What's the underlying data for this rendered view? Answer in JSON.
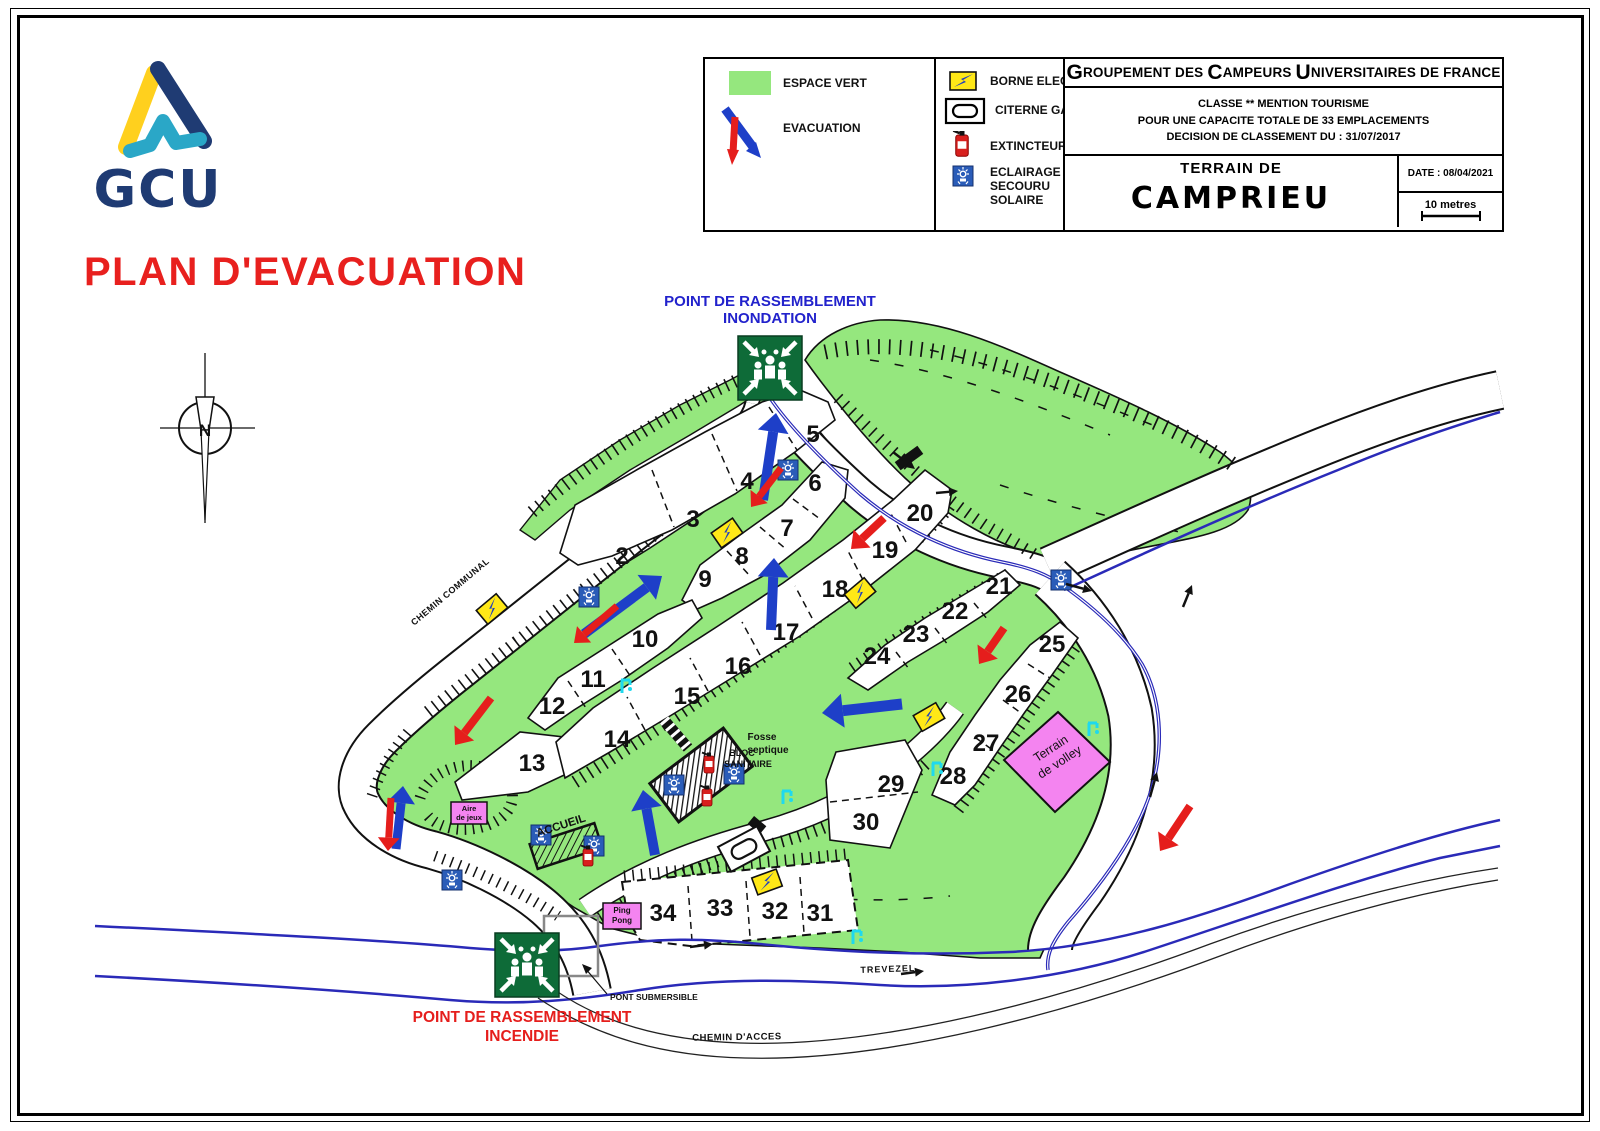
{
  "header": {
    "org_words": [
      [
        "G",
        "ROUPEMENT"
      ],
      [
        "",
        "DES"
      ],
      [
        "C",
        "AMPEURS"
      ],
      [
        "U",
        "NIVERSITAIRES"
      ],
      [
        "",
        "DE"
      ],
      [
        "",
        "FRANCE"
      ]
    ],
    "classification": [
      "CLASSE ** MENTION TOURISME",
      "POUR UNE CAPACITE TOTALE DE 33 EMPLACEMENTS",
      "DECISION DE CLASSEMENT DU : 31/07/2017"
    ],
    "terrain_label": "TERRAIN DE",
    "site_name": "CAMPRIEU",
    "date": "DATE : 08/04/2021",
    "scale": "10 metres"
  },
  "logo": {
    "text": "GCU"
  },
  "plan_title": "PLAN D'EVACUATION",
  "compass_n": "N",
  "legend": {
    "espace_vert": "ESPACE VERT",
    "evacuation": "EVACUATION",
    "borne": "BORNE ELECTRIQUE",
    "citerne": "CITERNE GAZ",
    "extincteur": "EXTINCTEUR",
    "eclairage": "ECLAIRAGE SECOURU SOLAIRE"
  },
  "map": {
    "assembly_flood": [
      "POINT DE RASSEMBLEMENT",
      "INONDATION"
    ],
    "assembly_fire": [
      "POINT DE RASSEMBLEMENT",
      "INCENDIE"
    ],
    "labels": {
      "chemin_communal": "CHEMIN COMMUNAL",
      "trevezel": "TREVEZEL",
      "chemin_acces": "CHEMIN D'ACCES",
      "pont_submersible": "PONT SUBMERSIBLE",
      "fosse": [
        "Fosse",
        "septique"
      ],
      "bloc": [
        "BLOC",
        "SANITAIRE"
      ],
      "accueil": "ACCUEIL",
      "volley": [
        "Terrain",
        "de volley"
      ],
      "aire": [
        "Aire",
        "de jeux"
      ],
      "pingpong": [
        "Ping",
        "Pong"
      ]
    },
    "plots": [
      {
        "n": "2",
        "x": 622,
        "y": 564
      },
      {
        "n": "3",
        "x": 693,
        "y": 527
      },
      {
        "n": "4",
        "x": 747,
        "y": 489
      },
      {
        "n": "5",
        "x": 813,
        "y": 442
      },
      {
        "n": "6",
        "x": 815,
        "y": 491
      },
      {
        "n": "7",
        "x": 787,
        "y": 536
      },
      {
        "n": "8",
        "x": 742,
        "y": 564
      },
      {
        "n": "9",
        "x": 705,
        "y": 587
      },
      {
        "n": "10",
        "x": 645,
        "y": 647
      },
      {
        "n": "11",
        "x": 593,
        "y": 687
      },
      {
        "n": "12",
        "x": 552,
        "y": 714
      },
      {
        "n": "13",
        "x": 532,
        "y": 771
      },
      {
        "n": "14",
        "x": 617,
        "y": 747
      },
      {
        "n": "15",
        "x": 687,
        "y": 704
      },
      {
        "n": "16",
        "x": 738,
        "y": 674
      },
      {
        "n": "17",
        "x": 786,
        "y": 640
      },
      {
        "n": "18",
        "x": 835,
        "y": 597
      },
      {
        "n": "19",
        "x": 885,
        "y": 558
      },
      {
        "n": "20",
        "x": 920,
        "y": 521
      },
      {
        "n": "21",
        "x": 999,
        "y": 594
      },
      {
        "n": "22",
        "x": 955,
        "y": 619
      },
      {
        "n": "23",
        "x": 916,
        "y": 642
      },
      {
        "n": "24",
        "x": 877,
        "y": 664
      },
      {
        "n": "25",
        "x": 1052,
        "y": 652
      },
      {
        "n": "26",
        "x": 1018,
        "y": 702
      },
      {
        "n": "27",
        "x": 986,
        "y": 751
      },
      {
        "n": "28",
        "x": 953,
        "y": 784
      },
      {
        "n": "29",
        "x": 891,
        "y": 792
      },
      {
        "n": "30",
        "x": 866,
        "y": 830
      },
      {
        "n": "31",
        "x": 820,
        "y": 921
      },
      {
        "n": "32",
        "x": 775,
        "y": 919
      },
      {
        "n": "33",
        "x": 720,
        "y": 916
      },
      {
        "n": "34",
        "x": 663,
        "y": 921
      }
    ],
    "icons": {
      "borne": [
        [
          492,
          609,
          -40
        ],
        [
          727,
          533,
          -35
        ],
        [
          860,
          593,
          -40
        ],
        [
          929,
          717,
          -30
        ],
        [
          767,
          882,
          -20
        ]
      ],
      "solar": [
        [
          589,
          597
        ],
        [
          788,
          470
        ],
        [
          1061,
          580
        ],
        [
          674,
          785
        ],
        [
          734,
          774
        ],
        [
          541,
          835
        ],
        [
          594,
          846
        ],
        [
          452,
          880
        ]
      ],
      "extincteur": [
        [
          709,
          764
        ],
        [
          707,
          797
        ],
        [
          588,
          857
        ]
      ],
      "tap": [
        [
          783,
          788
        ],
        [
          933,
          760
        ],
        [
          1089,
          720
        ],
        [
          622,
          677
        ],
        [
          853,
          928
        ]
      ]
    },
    "evac_arrows": [
      {
        "x1": 763,
        "y1": 500,
        "x2": 776,
        "y2": 413,
        "c": "#1E3FC8",
        "w": 10
      },
      {
        "x1": 781,
        "y1": 468,
        "x2": 751,
        "y2": 507,
        "c": "#E51E1C",
        "w": 7
      },
      {
        "x1": 771,
        "y1": 630,
        "x2": 774,
        "y2": 558,
        "c": "#1E3FC8",
        "w": 10
      },
      {
        "x1": 584,
        "y1": 634,
        "x2": 662,
        "y2": 576,
        "c": "#1E3FC8",
        "w": 10
      },
      {
        "x1": 617,
        "y1": 606,
        "x2": 574,
        "y2": 643,
        "c": "#E51E1C",
        "w": 7
      },
      {
        "x1": 884,
        "y1": 518,
        "x2": 851,
        "y2": 549,
        "c": "#E51E1C",
        "w": 8
      },
      {
        "x1": 1004,
        "y1": 628,
        "x2": 979,
        "y2": 664,
        "c": "#E51E1C",
        "w": 8
      },
      {
        "x1": 902,
        "y1": 704,
        "x2": 822,
        "y2": 713,
        "c": "#1E3FC8",
        "w": 11
      },
      {
        "x1": 655,
        "y1": 855,
        "x2": 643,
        "y2": 790,
        "c": "#1E3FC8",
        "w": 10
      },
      {
        "x1": 396,
        "y1": 849,
        "x2": 403,
        "y2": 786,
        "c": "#1E3FC8",
        "w": 9
      },
      {
        "x1": 391,
        "y1": 798,
        "x2": 388,
        "y2": 851,
        "c": "#E51E1C",
        "w": 7
      },
      {
        "x1": 491,
        "y1": 698,
        "x2": 455,
        "y2": 745,
        "c": "#E51E1C",
        "w": 8
      },
      {
        "x1": 1190,
        "y1": 806,
        "x2": 1160,
        "y2": 851,
        "c": "#E51E1C",
        "w": 8
      }
    ],
    "flow_arrows": [
      {
        "x1": 893,
        "y1": 452,
        "x2": 915,
        "y2": 469
      },
      {
        "x1": 1066,
        "y1": 584,
        "x2": 1092,
        "y2": 591
      },
      {
        "x1": 936,
        "y1": 493,
        "x2": 958,
        "y2": 491
      },
      {
        "x1": 690,
        "y1": 947,
        "x2": 713,
        "y2": 944
      },
      {
        "x1": 901,
        "y1": 974,
        "x2": 924,
        "y2": 971
      },
      {
        "x1": 1150,
        "y1": 797,
        "x2": 1157,
        "y2": 772
      },
      {
        "x1": 1183,
        "y1": 607,
        "x2": 1192,
        "y2": 585
      }
    ],
    "colors": {
      "green": "#95E77E",
      "dark_green": "#0E6B38",
      "evac_blue": "#1E3FC8",
      "alert_red": "#E51E1C",
      "river_blue": "#2A2AB8",
      "pink": "#F484F0",
      "borne_yellow": "#FFE817",
      "solar_blue": "#2A5CB8",
      "tap_cyan": "#1FD9EE",
      "logo_navy": "#1F3B73",
      "logo_yellow": "#FFD01E",
      "logo_teal": "#2AA7C7"
    }
  }
}
